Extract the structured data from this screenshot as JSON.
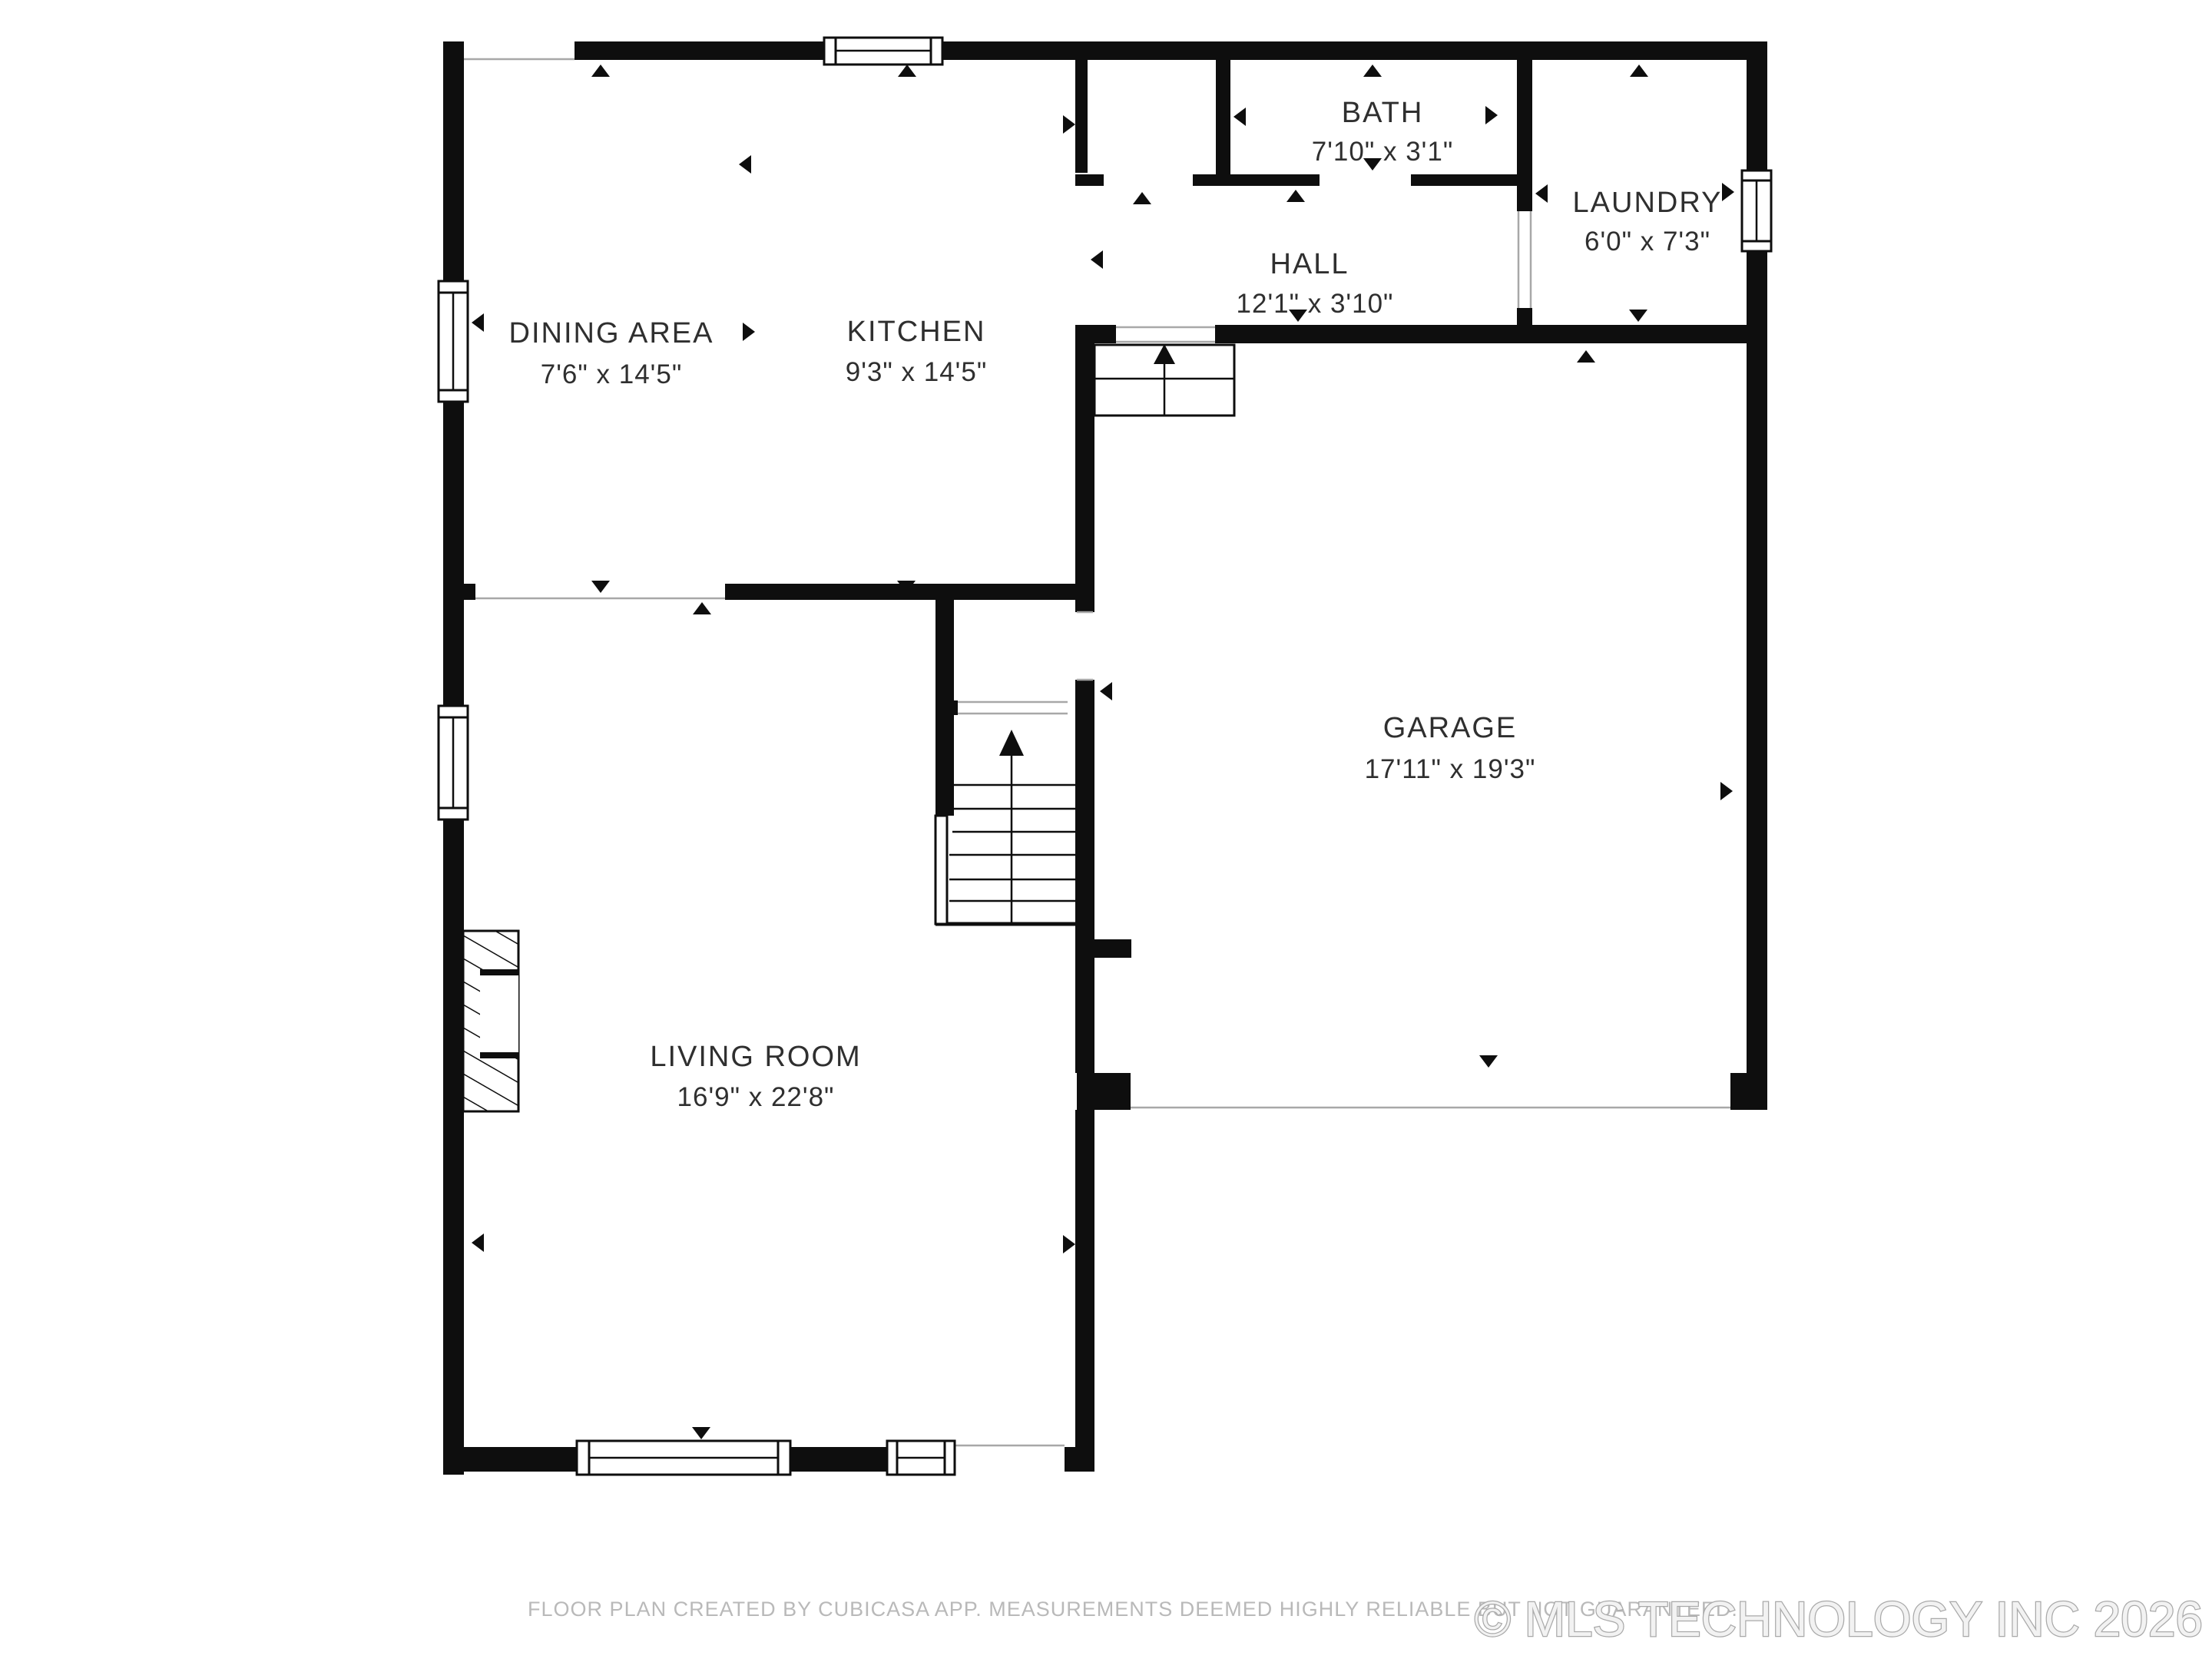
{
  "title": "Floor plan - first floor",
  "colors": {
    "wall": "#0e0e0e",
    "label": "#2f2f2f",
    "opening_line": "#a8a8a8",
    "disclaimer": "#b9b9b9",
    "watermark_fill": "#f2f2f2",
    "watermark_stroke": "#a9a9a9"
  },
  "rooms": [
    {
      "name": "DINING AREA",
      "dims": "7'6\" x 14'5\""
    },
    {
      "name": "KITCHEN",
      "dims": "9'3\" x 14'5\""
    },
    {
      "name": "BATH",
      "dims": "7'10\" x 3'1\""
    },
    {
      "name": "HALL",
      "dims": "12'1\" x 3'10\""
    },
    {
      "name": "LAUNDRY",
      "dims": "6'0\" x 7'3\""
    },
    {
      "name": "GARAGE",
      "dims": "17'11\" x 19'3\""
    },
    {
      "name": "LIVING ROOM",
      "dims": "16'9\" x 22'8\""
    }
  ],
  "footer": {
    "disclaimer": "FLOOR PLAN CREATED BY CUBICASA APP. MEASUREMENTS DEEMED HIGHLY RELIABLE BUT NOT GUARANTEED.",
    "watermark": "© MLS TECHNOLOGY INC 2026"
  }
}
